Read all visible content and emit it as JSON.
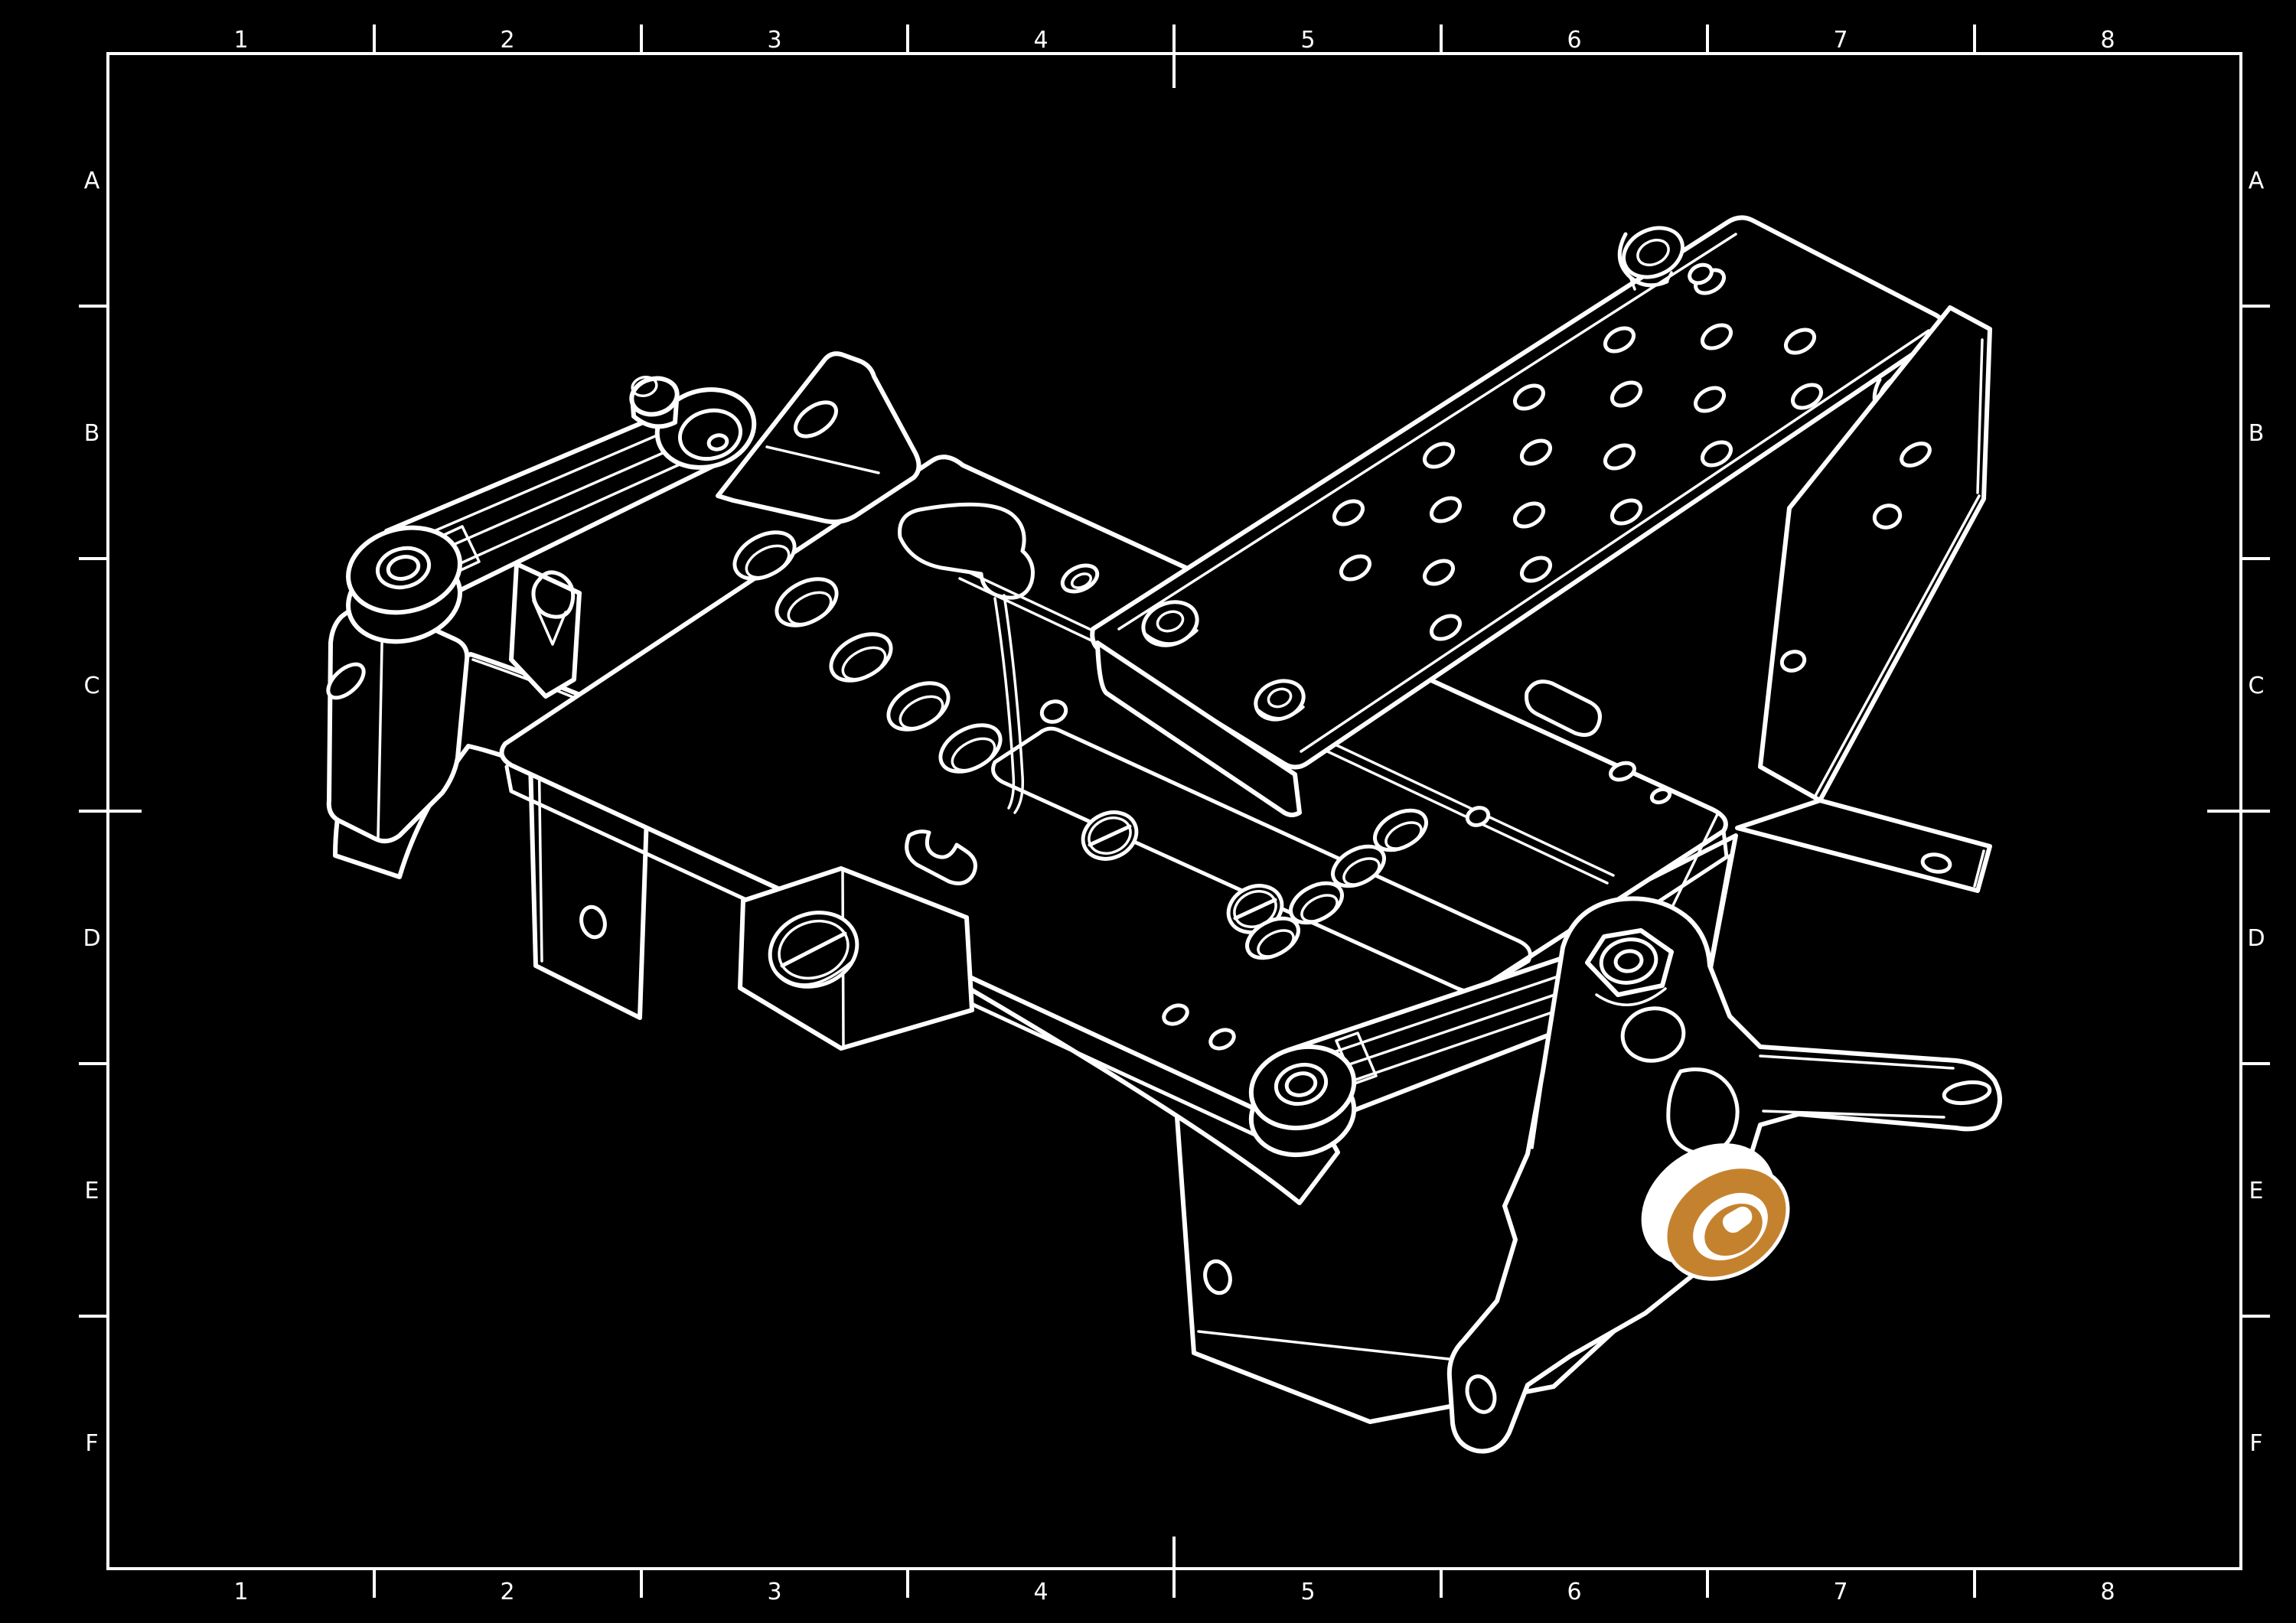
{
  "sheet": {
    "zones": {
      "columns": [
        "1",
        "2",
        "3",
        "4",
        "5",
        "6",
        "7",
        "8"
      ],
      "rows": [
        "A",
        "B",
        "C",
        "D",
        "E",
        "F"
      ]
    }
  },
  "colors": {
    "background": "#000000",
    "line": "#ffffff",
    "highlight_blue": "#94abca",
    "highlight_orange": "#c5822e"
  },
  "assembly": {
    "kind": "isometric-cad-line-drawing",
    "parts": [
      {
        "id": "base-plate",
        "highlighted": false,
        "highlight_color": null
      },
      {
        "id": "perforated-mount-plate",
        "highlighted": false,
        "highlight_color": null
      },
      {
        "id": "side-panel",
        "highlighted": false,
        "highlight_color": null
      },
      {
        "id": "front-panel",
        "highlighted": false,
        "highlight_color": null
      },
      {
        "id": "support-rail",
        "highlighted": false,
        "highlight_color": null
      },
      {
        "id": "screw-bracket",
        "highlighted": false,
        "highlight_color": null
      },
      {
        "id": "left-mount-bracket",
        "highlighted": true,
        "highlight_color": "#94abca"
      },
      {
        "id": "upper-link-arm",
        "highlighted": true,
        "highlight_color": "#94abca"
      },
      {
        "id": "upper-link-bracket",
        "highlighted": true,
        "highlight_color": "#94abca"
      },
      {
        "id": "lower-link-arm",
        "highlighted": true,
        "highlight_color": "#94abca"
      },
      {
        "id": "pivot-bracket",
        "highlighted": true,
        "highlight_color": "#94abca"
      },
      {
        "id": "roller-bearing",
        "highlighted": true,
        "highlight_color": "#c5822e"
      }
    ]
  }
}
